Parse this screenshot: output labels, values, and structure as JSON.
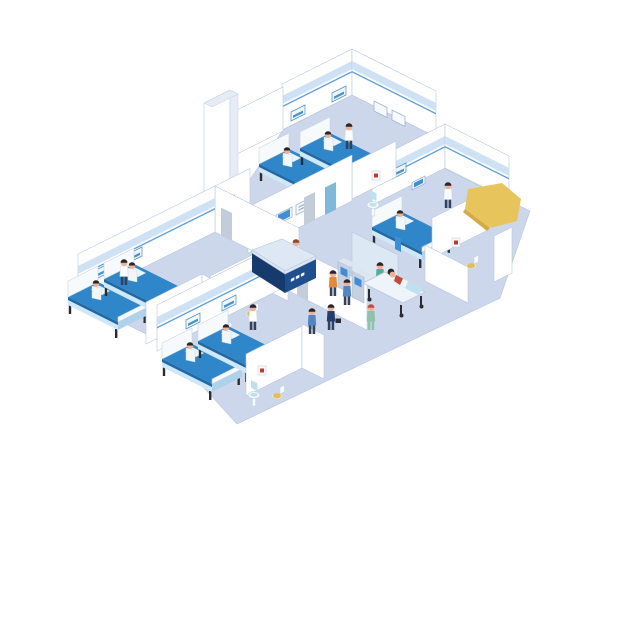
{
  "canvas": {
    "width": 640,
    "height": 640,
    "background": "#ffffff"
  },
  "scene": {
    "description": "Isometric cutaway illustration of a hospital ward floor",
    "rooms": [
      "patient ward top-right (2 beds)",
      "patient ward right (1 bed) with en-suite bathroom",
      "patient ward left (2 beds) with en-suite bathroom",
      "patient ward bottom (2 beds) with en-suite bathroom",
      "reception lobby with display wall",
      "elevator lobby with supply cabinet",
      "utility washroom nook"
    ],
    "people": [
      "receptionist behind desk",
      "nurse in top-right ward",
      "nurse in right ward",
      "nurse in left ward",
      "nurse in bottom ward",
      "nurse in green uniform walking in lobby",
      "orderly in scrubs beside gurney",
      "patient lying on gurney",
      "doctor in navy suit with briefcase",
      "visitor in blue shirt",
      "visitor at kiosk in orange shirt",
      "visitor at kiosk in blue shirt",
      "person waiting at elevator",
      "staff member at supply cabinet",
      "7 patients sitting up in beds"
    ],
    "equipment": {
      "hospital_beds": 7,
      "gurney": 1,
      "plant_stands": 6,
      "wall_display_panels": 3,
      "self_service_kiosks": 2,
      "sinks": 5,
      "toilets": 4,
      "wall_pictures": 5,
      "headboard_signs": 7,
      "elevator": 1,
      "reception_desk": 1,
      "glass_partition": 1,
      "yellow_highlight_marker": 1
    }
  },
  "colors": {
    "bg": "#ffffff",
    "outline": "#b9c6de",
    "floor": "#ccd7ec",
    "wall": "#ffffff",
    "wall_shade": "#e7ebf5",
    "stripe": "#cfe2f5",
    "stripe_line": "#5f9fd8",
    "sign": "#eef6fc",
    "sign_line": "#4a90d0",
    "panel": "#f6fafd",
    "panel_line": "#9fb4cc",
    "screen": "#3f8fd6",
    "bed_blue": "#2f87c9",
    "bed_blue_dark": "#2268a4",
    "bed_base": "#cfe8f7",
    "bed_base2": "#aed2ea",
    "bed_frame": "#f7fafd",
    "pillow": "#e9f4fb",
    "leg": "#2b2b33",
    "plant": "#4f9e55",
    "plant_dark": "#3a7a43",
    "pot": "#7fb5c9",
    "cab_top": "#bfe2ef",
    "cab_front": "#eef5fa",
    "cab_side": "#d6e7f2",
    "desk_navy": "#1f4e8e",
    "desk_navy2": "#173a6d",
    "desk_top": "#dde8f4",
    "door_gray": "#c3cdda",
    "door_blue": "#7fb9d9",
    "glass": "#dce8f4",
    "skin": "#f1b191",
    "hair_dark": "#26262e",
    "hair_brown": "#8a4a2e",
    "hair_red": "#c14b3a",
    "coat": "#fbfdfe",
    "gown": "#f2f6f9",
    "scrub": "#58ab9c",
    "dress_green": "#8cc3ab",
    "suit": "#243f6e",
    "shirt_blue": "#4f86c8",
    "shirt_orange": "#e2893b",
    "pants_dark": "#33415c",
    "gurney": "#eef4fa",
    "gurney_frame": "#b9c9db",
    "yellow": "#e7c45c",
    "yellow_dark": "#d2ab45",
    "fixture": "#f8fbfd",
    "fixture_blue": "#bfe0ee",
    "seat_yellow": "#e3bd55",
    "picture_red": "#c0392b",
    "kiosk": "#c6d2e1",
    "kiosk_top": "#dde6f0"
  }
}
